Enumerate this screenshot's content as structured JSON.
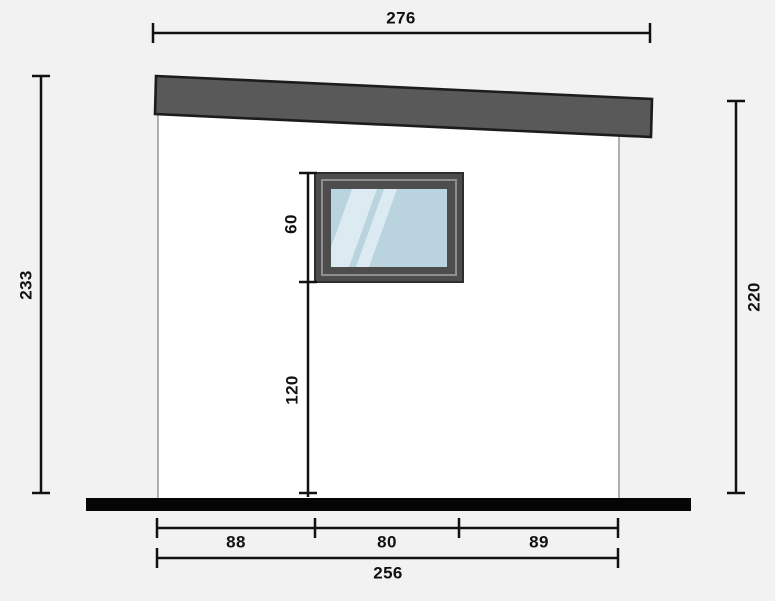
{
  "drawing": {
    "labels": {
      "roof_width": "276",
      "height_left": "233",
      "height_right": "220",
      "window_height": "60",
      "window_bottom_to_ground": "120",
      "ground_left_segment": "88",
      "ground_middle_segment": "80",
      "ground_right_segment": "89",
      "ground_total": "256"
    },
    "colors": {
      "background": "#f2f2f2",
      "building_fill": "#ffffff",
      "building_stroke": "#9e9e9e",
      "roof_fill": "#595959",
      "roof_stroke": "#1c1c1c",
      "ground_fill": "#050505",
      "dimension_stroke": "#111111",
      "label_color": "#111111",
      "window_frame_fill": "#4d4d4d",
      "window_frame_stroke": "#2e2e2e",
      "window_inner_stroke": "#8f8f8f",
      "glass_fill": "#b9d3df",
      "glass_highlight": "#dcebf2"
    }
  }
}
